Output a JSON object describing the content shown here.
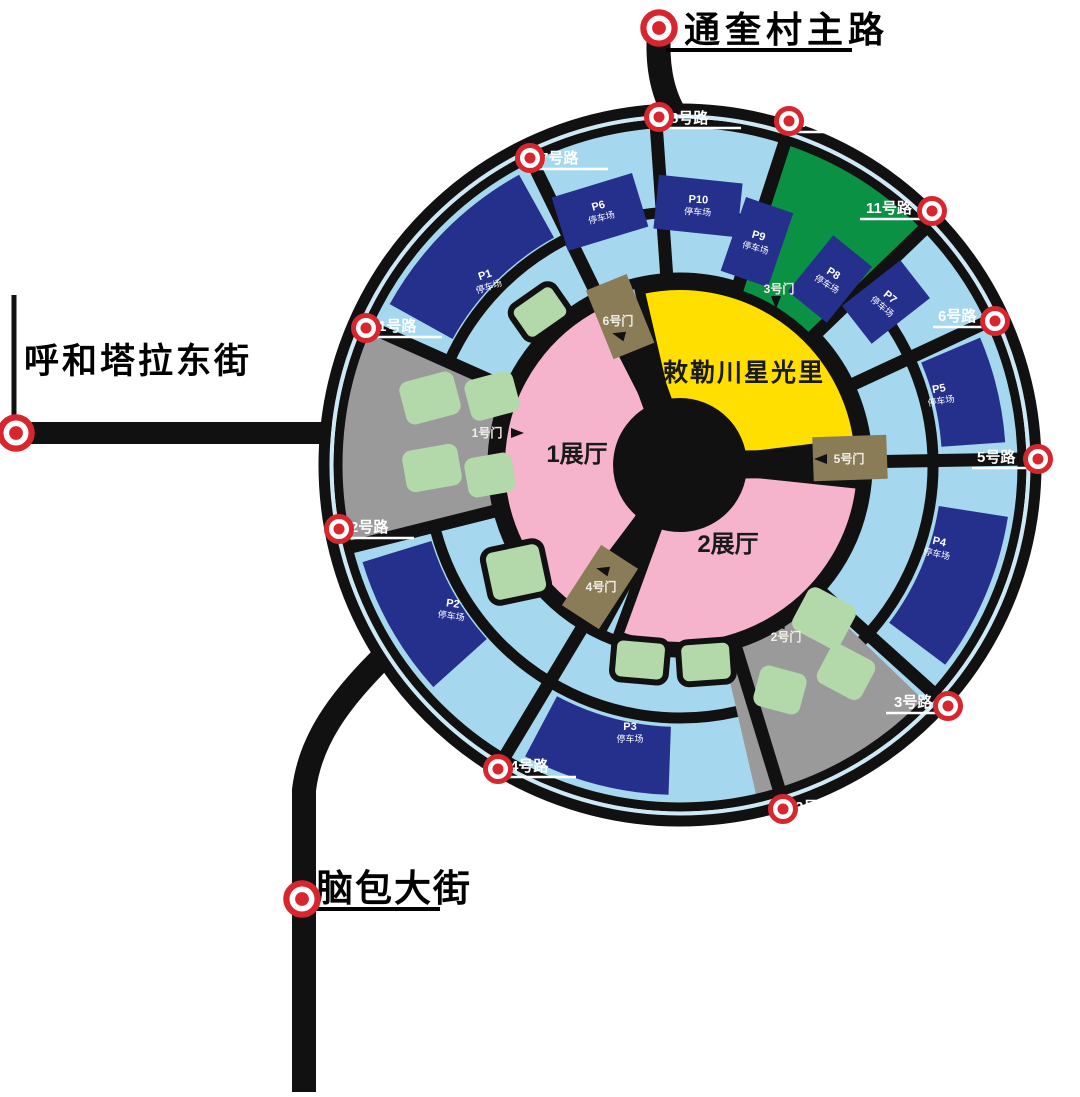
{
  "streets": {
    "top": "通奎村主路",
    "west": "呼和塔拉东街",
    "south": "脑包大街"
  },
  "venue": {
    "name": "敕勒川星光里",
    "hall1": "1展厅",
    "hall2": "2展厅"
  },
  "roads": {
    "r1": "1号路",
    "r2": "2号路",
    "r3": "3号路",
    "r4": "4号路",
    "r5": "5号路",
    "r6": "6号路",
    "r7": "7号路",
    "r8": "8号路",
    "r10": "10号路",
    "r11": "11号路"
  },
  "gates": {
    "g1": "1号门",
    "g2": "2号门",
    "g3": "3号门",
    "g4": "4号门",
    "g5": "5号门",
    "g6": "6号门"
  },
  "parking": {
    "suffix": "停车场",
    "p1": "P1",
    "p2": "P2",
    "p3": "P3",
    "p4": "P4",
    "p5": "P5",
    "p6": "P6",
    "p7": "P7",
    "p8": "P8",
    "p9": "P9",
    "p10": "P10"
  },
  "icons": {
    "location_marker": "red-ring-marker",
    "gate_arrow": "black-triangle-arrow"
  },
  "colors": {
    "map_field": "#a5d8ef",
    "road_black": "#111111",
    "parking_navy": "#25308d",
    "green_zone": "#0a9143",
    "venue_yellow": "#ffdf00",
    "hall_pink": "#f6b3cc",
    "plot_green": "#b3d8aa",
    "gray_zone": "#9a9a9a",
    "gate_khaki": "#8b7c58",
    "marker_red": "#d8262e",
    "ring_line": "#cde9f6"
  }
}
